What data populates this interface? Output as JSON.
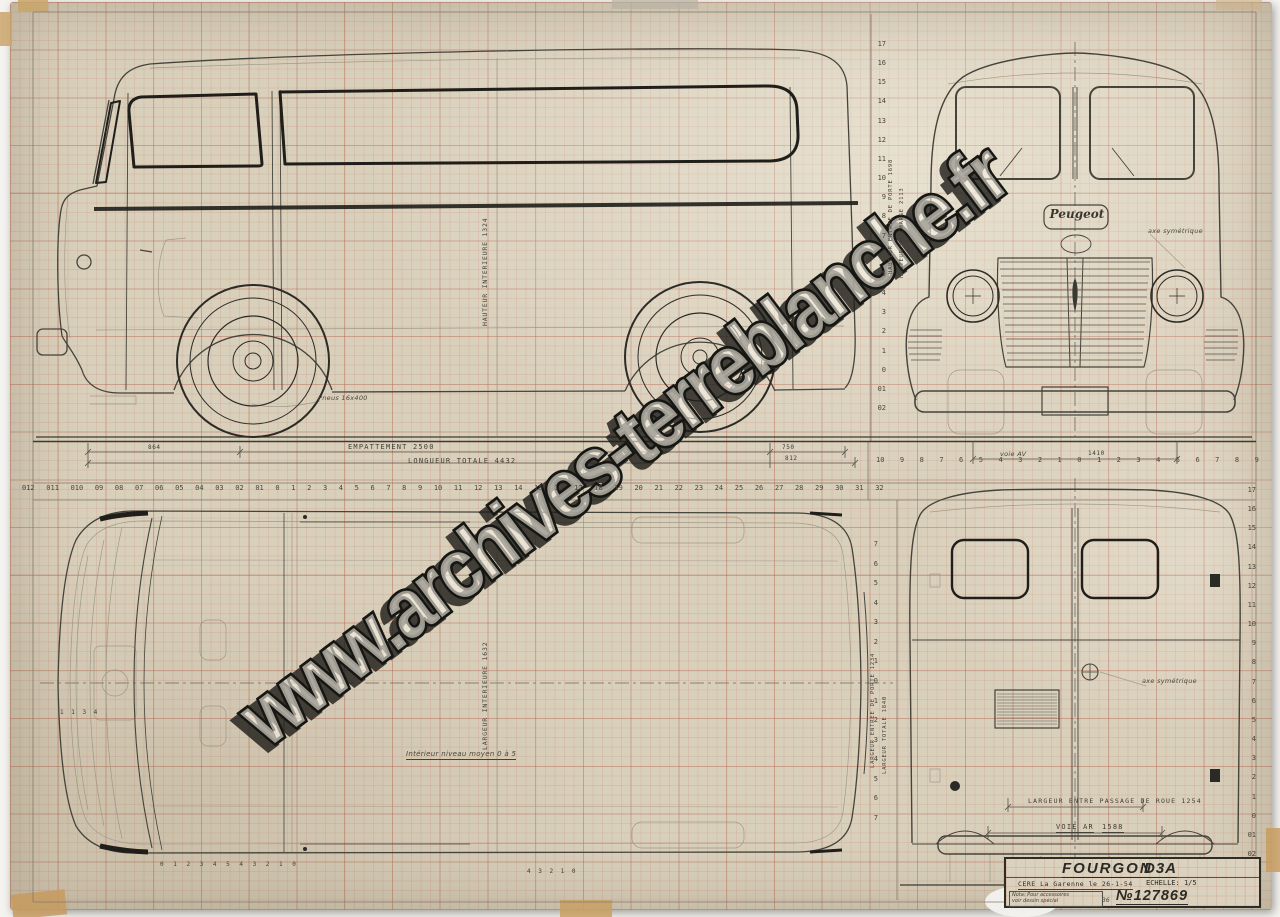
{
  "sheet": {
    "watermark": "www.archives-terreblanche.fr",
    "peugeot_badge": "Peugeot"
  },
  "title_block": {
    "title": "FOURGON",
    "model": "D3A",
    "origin": "CERE  La Garenne le 26-1-54",
    "scale_label": "ECHELLE:",
    "scale_value": "1/5",
    "nota_line1": "Nota: Pour accessoires",
    "nota_line2": "voir dessin spécial",
    "number_sign": "№",
    "drawing_number": "127869",
    "number_note": "36"
  },
  "labels": {
    "empattement": "EMPATTEMENT   2500",
    "longueur_totale": "LONGUEUR TOTALE   4432",
    "dim_864": "864",
    "dim_750": "750",
    "dim_812": "812",
    "voie_av": "voie AV",
    "voie_av_value": "1410",
    "voie_ar": "VOIE AR",
    "voie_ar_value": "1588",
    "largeur_entre_passage_de_roue": "LARGEUR ENTRE PASSAGE DE ROUE  1254",
    "hauteur_interieure": "HAUTEUR INTERIEURE 1324",
    "hauteur_entree_de_porte": "HAUTEUR ENTREE DE PORTE 1698",
    "hauteur_en_charge": "HAUTEUR EN CHARGE 2113",
    "largeur_interieure": "LARGEUR INTERIEURE 1632",
    "largeur_entree_de_porte": "LARGEUR ENTREE DE PORTE 1234",
    "largeur_totale": "LARGEUR TOTALE 1840",
    "pneus": "Pneus 16x400",
    "vitrage_note": "Intérieur niveau moyen 0 à 5",
    "axe_note_front": "axe symétrique",
    "axe_note_rear": "axe symétrique",
    "plan_marks": "1 1 3 4",
    "section_marks_a": "0 1 2  3  4    5    4   3 2 1 0",
    "section_marks_b": "4 3 2 1 0"
  },
  "scales": {
    "top_columns": [
      "012",
      "011",
      "010",
      "09",
      "08",
      "07",
      "06",
      "05",
      "04",
      "03",
      "02",
      "01",
      "0",
      "1",
      "2",
      "3",
      "4",
      "5",
      "6",
      "7",
      "8",
      "9",
      "10",
      "11",
      "12",
      "13",
      "14",
      "15",
      "16",
      "17",
      "18",
      "19",
      "20",
      "21",
      "22",
      "23",
      "24",
      "25",
      "26",
      "27",
      "28",
      "29",
      "30",
      "31",
      "32"
    ],
    "right_columns": [
      "10",
      "9",
      "8",
      "7",
      "6",
      "5",
      "4",
      "3",
      "2",
      "1",
      "0",
      "1",
      "2",
      "3",
      "4",
      "5",
      "6",
      "7",
      "8",
      "9"
    ],
    "top_rows": [
      "17",
      "16",
      "15",
      "14",
      "13",
      "12",
      "11",
      "10",
      "9",
      "8",
      "7",
      "6",
      "5",
      "4",
      "3",
      "2",
      "1",
      "0",
      "01",
      "02"
    ],
    "bottom_rows": [
      "17",
      "16",
      "15",
      "14",
      "13",
      "12",
      "11",
      "10",
      "9",
      "8",
      "7",
      "6",
      "5",
      "4",
      "3",
      "2",
      "1",
      "0",
      "01",
      "02"
    ],
    "plan_rows": [
      "7",
      "6",
      "5",
      "4",
      "3",
      "2",
      "1",
      "0",
      "1",
      "2",
      "3",
      "4",
      "5",
      "6",
      "7"
    ]
  }
}
